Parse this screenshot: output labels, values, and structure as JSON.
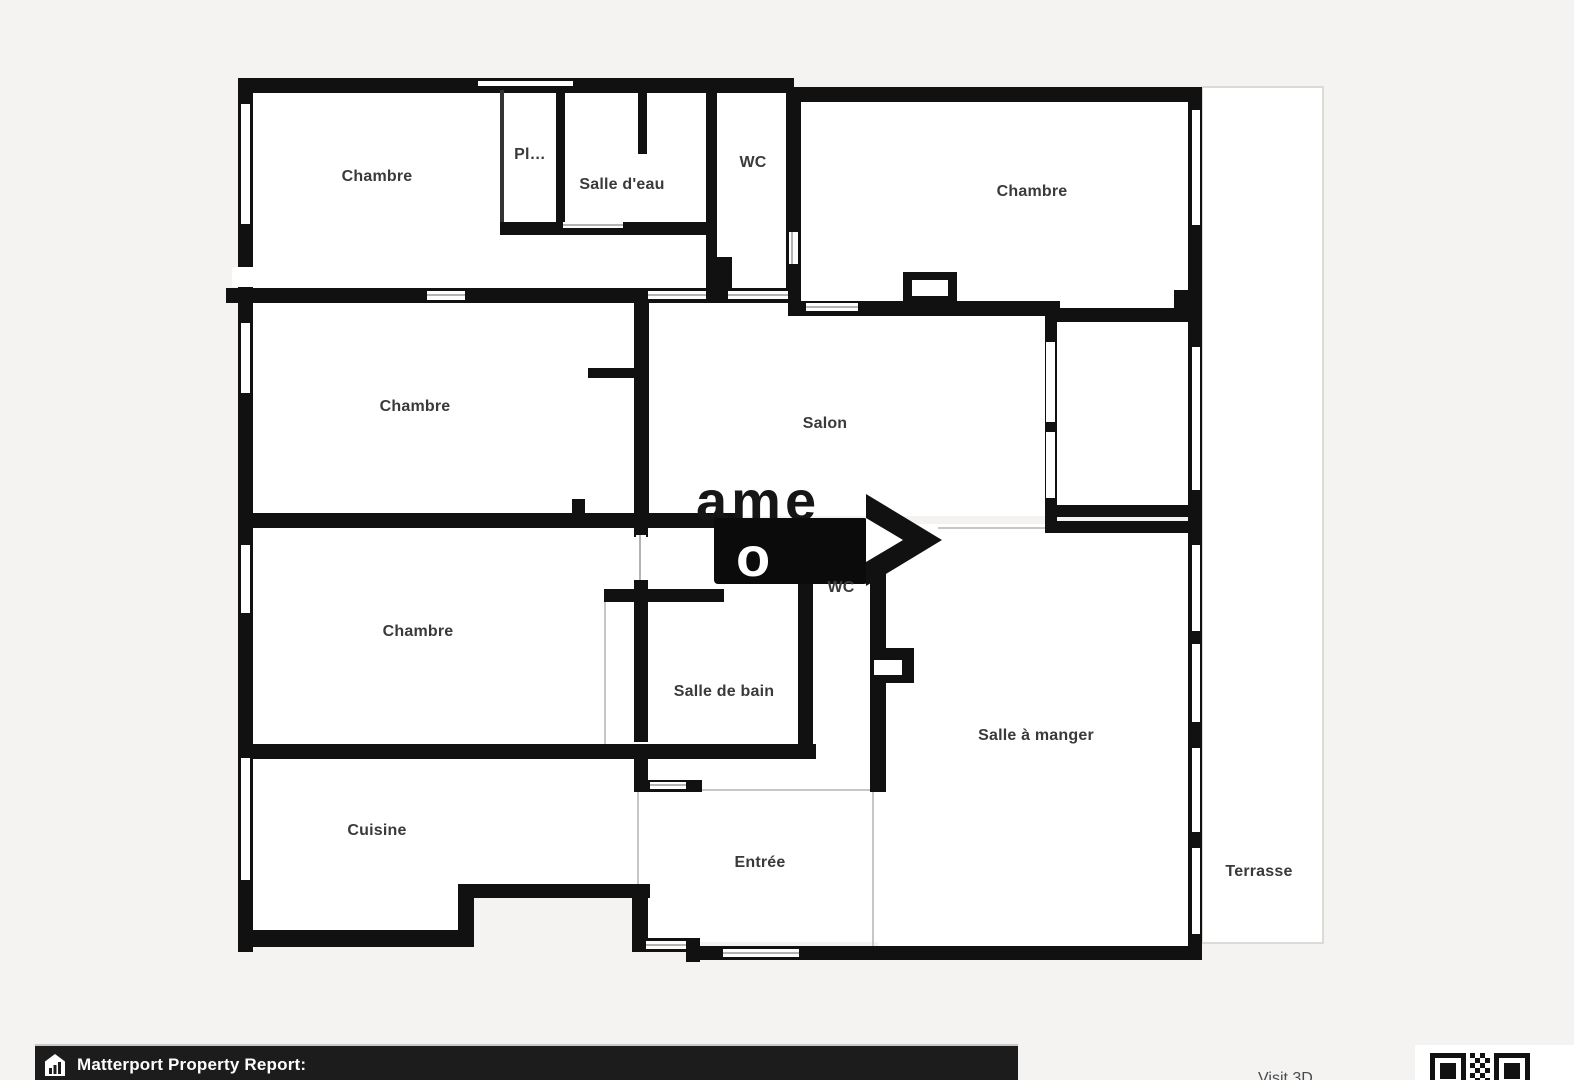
{
  "plan": {
    "rooms": [
      {
        "name": "chambre-top-left",
        "label": "Chambre"
      },
      {
        "name": "placard",
        "label": "Pl…"
      },
      {
        "name": "salle-deau",
        "label": "Salle d'eau"
      },
      {
        "name": "wc-top",
        "label": "WC"
      },
      {
        "name": "chambre-top-right",
        "label": "Chambre"
      },
      {
        "name": "chambre-middle-left",
        "label": "Chambre"
      },
      {
        "name": "salon",
        "label": "Salon"
      },
      {
        "name": "chambre-lower-left",
        "label": "Chambre"
      },
      {
        "name": "salle-de-bain",
        "label": "Salle de bain"
      },
      {
        "name": "wc-middle",
        "label": "WC"
      },
      {
        "name": "salle-a-manger",
        "label": "Salle à manger"
      },
      {
        "name": "cuisine",
        "label": "Cuisine"
      },
      {
        "name": "entree",
        "label": "Entrée"
      },
      {
        "name": "terrasse",
        "label": "Terrasse"
      }
    ],
    "watermark": {
      "row1": "ame",
      "row2": "o"
    }
  },
  "footer": {
    "report_label": "Matterport Property Report:",
    "visit_label": "Visit 3D"
  },
  "colors": {
    "wall": "#111111",
    "background": "#f4f3f1",
    "floor": "#ffffff",
    "bar": "#1d1c1c",
    "label": "#3a3a3a"
  }
}
